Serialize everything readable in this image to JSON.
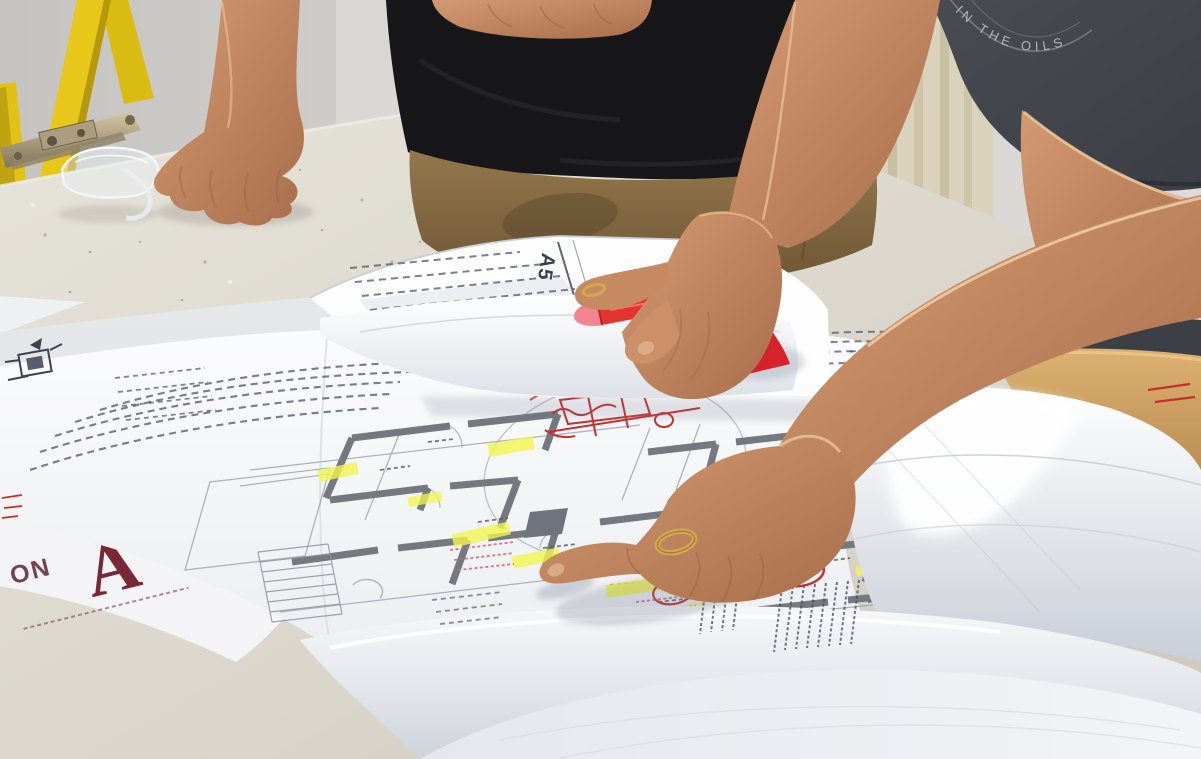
{
  "scene": {
    "description": "Two workers lean over architectural floor plans spread across a white table; one points at the plan, the other grips a curled sheet corner and a red marker. A yellow stepladder and clear safety glasses sit in the background.",
    "width_px": 1201,
    "height_px": 759
  },
  "labels": {
    "sheet_tag": "A5",
    "shirt_logo_text": "IN THE OILS",
    "plan_logo_prefix": "ON",
    "plan_logo_letter": "A"
  },
  "colors": {
    "ladder_yellow": "#e6c71a",
    "marker_red": "#e23531",
    "marker_tip_pink": "#f2858f",
    "highlighter_yellow": "#f3f54e",
    "red_ink": "#c5302e",
    "pink_ink": "#d4687b",
    "logo_maroon": "#7a2737",
    "gold_ring": "#d4a74f",
    "table_top": "#dcd8cd",
    "wall": "#cfcdca",
    "black_tshirt": "#17171a",
    "khaki_pants": "#8b6f44",
    "gray_tshirt": "#45484e",
    "skin": "#c08a64",
    "paper_white": "#fafbfc",
    "plan_ink": "#4c5568"
  }
}
